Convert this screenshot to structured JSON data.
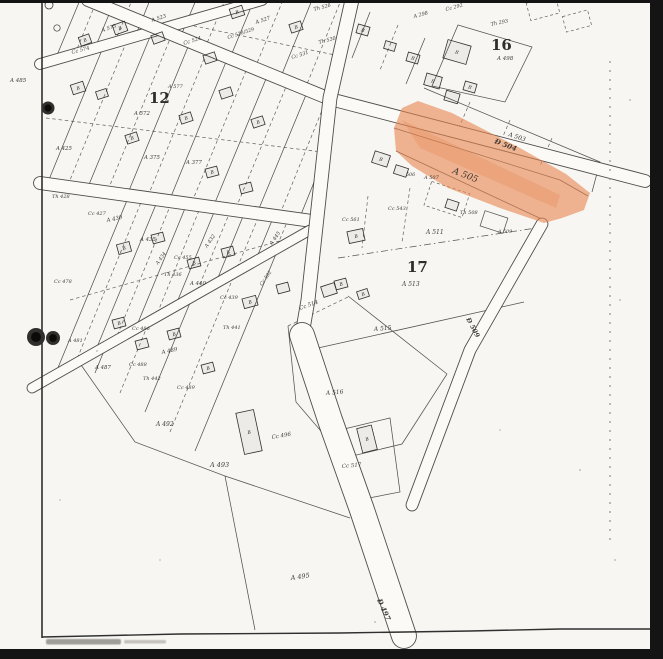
{
  "page": {
    "paper_color": "#f7f6f2",
    "ink_color": "#2e2c28",
    "scan_bar_color": "#141414",
    "highlight_color": "#e8854e"
  },
  "map": {
    "description": "scanned cadastral parcel map sheet with orange-highlighted parcel",
    "highlighted_parcel": "A 505",
    "block_numbers": [
      {
        "text": "12",
        "x": 149,
        "y": 103,
        "size": 15
      },
      {
        "text": "16",
        "x": 491,
        "y": 50,
        "size": 15
      },
      {
        "text": "17",
        "x": 407,
        "y": 272,
        "size": 15
      }
    ],
    "road_labels": [
      {
        "text": "Đ 504",
        "x": 494,
        "y": 143,
        "rot": 21,
        "size": 7
      },
      {
        "text": "Đ 497",
        "x": 377,
        "y": 600,
        "rot": 66,
        "size": 7
      },
      {
        "text": "Đ 509",
        "x": 466,
        "y": 319,
        "rot": 62,
        "size": 6.5
      }
    ],
    "margin_labels": [
      {
        "text": "A 485",
        "x": 10,
        "y": 82,
        "rot": 0,
        "size": 5.5
      }
    ],
    "parcel_labels": [
      {
        "text": "Cc 574",
        "x": 72,
        "y": 54,
        "rot": -15,
        "size": 5.2
      },
      {
        "text": "A 575",
        "x": 102,
        "y": 32,
        "rot": -18,
        "size": 5.2
      },
      {
        "text": "A 523",
        "x": 152,
        "y": 22,
        "rot": -18,
        "size": 5.2
      },
      {
        "text": "Cc 524",
        "x": 184,
        "y": 45,
        "rot": -18,
        "size": 5.2
      },
      {
        "text": "Cc 528/529",
        "x": 228,
        "y": 39,
        "rot": -18,
        "size": 4.8
      },
      {
        "text": "A 527",
        "x": 256,
        "y": 24,
        "rot": -18,
        "size": 5.2
      },
      {
        "text": "Th 526",
        "x": 314,
        "y": 11,
        "rot": -15,
        "size": 5
      },
      {
        "text": "Th 530",
        "x": 319,
        "y": 44,
        "rot": -15,
        "size": 5
      },
      {
        "text": "Cc 531",
        "x": 292,
        "y": 59,
        "rot": -18,
        "size": 5
      },
      {
        "text": "A 298",
        "x": 414,
        "y": 18,
        "rot": -15,
        "size": 5
      },
      {
        "text": "Cc 292",
        "x": 446,
        "y": 11,
        "rot": -15,
        "size": 5
      },
      {
        "text": "Th 293",
        "x": 491,
        "y": 26,
        "rot": -12,
        "size": 5
      },
      {
        "text": "A 572",
        "x": 134,
        "y": 115,
        "rot": 0,
        "size": 5.4
      },
      {
        "text": "A 577",
        "x": 168,
        "y": 88,
        "rot": 0,
        "size": 5
      },
      {
        "text": "A 375",
        "x": 144,
        "y": 159,
        "rot": 0,
        "size": 5.4
      },
      {
        "text": "A 377",
        "x": 186,
        "y": 164,
        "rot": 0,
        "size": 5.4
      },
      {
        "text": "A 425",
        "x": 56,
        "y": 150,
        "rot": 0,
        "size": 5.4
      },
      {
        "text": "Th 428",
        "x": 52,
        "y": 198,
        "rot": 0,
        "size": 5
      },
      {
        "text": "Cc 427",
        "x": 88,
        "y": 215,
        "rot": 0,
        "size": 5
      },
      {
        "text": "A 430",
        "x": 107,
        "y": 222,
        "rot": -12,
        "size": 5.4
      },
      {
        "text": "A 435",
        "x": 140,
        "y": 241,
        "rot": 0,
        "size": 5.4
      },
      {
        "text": "Cc 455",
        "x": 174,
        "y": 259,
        "rot": 0,
        "size": 5
      },
      {
        "text": "A 432",
        "x": 207,
        "y": 248,
        "rot": -55,
        "size": 5
      },
      {
        "text": "A 434",
        "x": 158,
        "y": 265,
        "rot": -55,
        "size": 4.8
      },
      {
        "text": "Th 436",
        "x": 164,
        "y": 276,
        "rot": 0,
        "size": 5
      },
      {
        "text": "A 440",
        "x": 190,
        "y": 285,
        "rot": 0,
        "size": 5.4
      },
      {
        "text": "Cc 439",
        "x": 220,
        "y": 299,
        "rot": 0,
        "size": 5
      },
      {
        "text": "Th 441",
        "x": 223,
        "y": 329,
        "rot": 0,
        "size": 5
      },
      {
        "text": "A 445",
        "x": 272,
        "y": 245,
        "rot": -55,
        "size": 5
      },
      {
        "text": "Cc 502",
        "x": 262,
        "y": 286,
        "rot": -55,
        "size": 4.8
      },
      {
        "text": "Cc 478",
        "x": 54,
        "y": 283,
        "rot": 0,
        "size": 5
      },
      {
        "text": "A 481",
        "x": 68,
        "y": 342,
        "rot": 0,
        "size": 5
      },
      {
        "text": "A 487",
        "x": 95,
        "y": 369,
        "rot": 0,
        "size": 5.4
      },
      {
        "text": "Cc 486",
        "x": 132,
        "y": 330,
        "rot": 0,
        "size": 5
      },
      {
        "text": "A 489",
        "x": 162,
        "y": 354,
        "rot": -12,
        "size": 5.4
      },
      {
        "text": "Cc 488",
        "x": 129,
        "y": 366,
        "rot": 0,
        "size": 5
      },
      {
        "text": "Th 442",
        "x": 143,
        "y": 380,
        "rot": 0,
        "size": 5
      },
      {
        "text": "Cc 489",
        "x": 177,
        "y": 389,
        "rot": 0,
        "size": 5
      },
      {
        "text": "A 492",
        "x": 156,
        "y": 426,
        "rot": 0,
        "size": 6
      },
      {
        "text": "A 493",
        "x": 210,
        "y": 467,
        "rot": 0,
        "size": 6.5
      },
      {
        "text": "Cc 496",
        "x": 272,
        "y": 439,
        "rot": -10,
        "size": 5.5
      },
      {
        "text": "A 495",
        "x": 291,
        "y": 580,
        "rot": -8,
        "size": 6.5
      },
      {
        "text": "A 516",
        "x": 326,
        "y": 395,
        "rot": -5,
        "size": 6
      },
      {
        "text": "Cc 517",
        "x": 342,
        "y": 468,
        "rot": -5,
        "size": 5.5
      },
      {
        "text": "Cc 514",
        "x": 300,
        "y": 310,
        "rot": -20,
        "size": 5.5
      },
      {
        "text": "A 515",
        "x": 374,
        "y": 331,
        "rot": -5,
        "size": 6
      },
      {
        "text": "A 513",
        "x": 402,
        "y": 286,
        "rot": 0,
        "size": 6
      },
      {
        "text": "A 511",
        "x": 426,
        "y": 234,
        "rot": 0,
        "size": 6
      },
      {
        "text": "Cc 561",
        "x": 342,
        "y": 221,
        "rot": 0,
        "size": 5
      },
      {
        "text": "Cc 543",
        "x": 388,
        "y": 210,
        "rot": 0,
        "size": 5
      },
      {
        "text": "Th 508",
        "x": 460,
        "y": 214,
        "rot": 0,
        "size": 5
      },
      {
        "text": "A 509",
        "x": 498,
        "y": 233,
        "rot": 0,
        "size": 4.8
      },
      {
        "text": "A 507",
        "x": 424,
        "y": 179,
        "rot": 0,
        "size": 5
      },
      {
        "text": "506",
        "x": 406,
        "y": 176,
        "rot": 0,
        "size": 4.8
      },
      {
        "text": "A 505",
        "x": 452,
        "y": 173,
        "rot": 21,
        "size": 9
      },
      {
        "text": "A 503",
        "x": 508,
        "y": 136,
        "rot": 18,
        "size": 6
      },
      {
        "text": "A 498",
        "x": 497,
        "y": 60,
        "rot": 0,
        "size": 5.5
      }
    ],
    "buildings": [
      {
        "x": 120,
        "y": 28,
        "w": 13,
        "h": 10,
        "rot": -20,
        "letter": "B"
      },
      {
        "x": 158,
        "y": 38,
        "w": 12,
        "h": 9,
        "rot": -20,
        "letter": ""
      },
      {
        "x": 237,
        "y": 12,
        "w": 13,
        "h": 10,
        "rot": -18,
        "letter": "B"
      },
      {
        "x": 296,
        "y": 27,
        "w": 12,
        "h": 9,
        "rot": -18,
        "letter": "B"
      },
      {
        "x": 210,
        "y": 58,
        "w": 12,
        "h": 9,
        "rot": -18,
        "letter": ""
      },
      {
        "x": 85,
        "y": 40,
        "w": 11,
        "h": 9,
        "rot": -20,
        "letter": "B"
      },
      {
        "x": 78,
        "y": 88,
        "w": 13,
        "h": 10,
        "rot": -18,
        "letter": "B"
      },
      {
        "x": 102,
        "y": 94,
        "w": 11,
        "h": 8,
        "rot": -18,
        "letter": ""
      },
      {
        "x": 132,
        "y": 138,
        "w": 12,
        "h": 9,
        "rot": -18,
        "letter": "B"
      },
      {
        "x": 186,
        "y": 118,
        "w": 12,
        "h": 9,
        "rot": -18,
        "letter": "B"
      },
      {
        "x": 226,
        "y": 93,
        "w": 12,
        "h": 9,
        "rot": -18,
        "letter": ""
      },
      {
        "x": 258,
        "y": 122,
        "w": 12,
        "h": 9,
        "rot": -18,
        "letter": "B"
      },
      {
        "x": 212,
        "y": 172,
        "w": 12,
        "h": 9,
        "rot": -15,
        "letter": "B"
      },
      {
        "x": 246,
        "y": 188,
        "w": 12,
        "h": 9,
        "rot": -15,
        "letter": ""
      },
      {
        "x": 363,
        "y": 30,
        "w": 12,
        "h": 9,
        "rot": 16,
        "letter": "B"
      },
      {
        "x": 390,
        "y": 46,
        "w": 11,
        "h": 8,
        "rot": 16,
        "letter": ""
      },
      {
        "x": 413,
        "y": 58,
        "w": 12,
        "h": 9,
        "rot": 16,
        "letter": "B"
      },
      {
        "x": 457,
        "y": 52,
        "w": 24,
        "h": 19,
        "rot": 16,
        "letter": "B"
      },
      {
        "x": 433,
        "y": 81,
        "w": 16,
        "h": 12,
        "rot": 16,
        "letter": "B"
      },
      {
        "x": 452,
        "y": 97,
        "w": 14,
        "h": 10,
        "rot": 16,
        "letter": ""
      },
      {
        "x": 470,
        "y": 87,
        "w": 12,
        "h": 9,
        "rot": 16,
        "letter": "B"
      },
      {
        "x": 381,
        "y": 159,
        "w": 16,
        "h": 12,
        "rot": 18,
        "letter": "B"
      },
      {
        "x": 401,
        "y": 171,
        "w": 13,
        "h": 9,
        "rot": 18,
        "letter": ""
      },
      {
        "x": 356,
        "y": 236,
        "w": 16,
        "h": 12,
        "rot": -12,
        "letter": "B"
      },
      {
        "x": 341,
        "y": 284,
        "w": 12,
        "h": 9,
        "rot": -15,
        "letter": "B"
      },
      {
        "x": 329,
        "y": 290,
        "w": 14,
        "h": 11,
        "rot": -18,
        "letter": ""
      },
      {
        "x": 363,
        "y": 294,
        "w": 11,
        "h": 8,
        "rot": -18,
        "letter": "B"
      },
      {
        "x": 367,
        "y": 439,
        "w": 15,
        "h": 25,
        "rot": -14,
        "letter": "B"
      },
      {
        "x": 249,
        "y": 432,
        "w": 18,
        "h": 42,
        "rot": -12,
        "letter": "B"
      },
      {
        "x": 124,
        "y": 248,
        "w": 13,
        "h": 10,
        "rot": -15,
        "letter": "B"
      },
      {
        "x": 158,
        "y": 238,
        "w": 12,
        "h": 9,
        "rot": -15,
        "letter": ""
      },
      {
        "x": 194,
        "y": 263,
        "w": 12,
        "h": 9,
        "rot": -15,
        "letter": "B"
      },
      {
        "x": 228,
        "y": 252,
        "w": 12,
        "h": 9,
        "rot": -15,
        "letter": "B"
      },
      {
        "x": 250,
        "y": 302,
        "w": 14,
        "h": 10,
        "rot": -15,
        "letter": "B"
      },
      {
        "x": 283,
        "y": 288,
        "w": 12,
        "h": 9,
        "rot": -15,
        "letter": ""
      },
      {
        "x": 119,
        "y": 323,
        "w": 12,
        "h": 9,
        "rot": -15,
        "letter": "B"
      },
      {
        "x": 142,
        "y": 344,
        "w": 12,
        "h": 9,
        "rot": -15,
        "letter": ""
      },
      {
        "x": 174,
        "y": 334,
        "w": 12,
        "h": 9,
        "rot": -15,
        "letter": "B"
      },
      {
        "x": 208,
        "y": 368,
        "w": 12,
        "h": 9,
        "rot": -15,
        "letter": "B"
      },
      {
        "x": 452,
        "y": 205,
        "w": 12,
        "h": 9,
        "rot": 18,
        "letter": ""
      }
    ],
    "binder_holes": [
      {
        "x": 48,
        "y": 108,
        "r": 6.5
      },
      {
        "x": 36,
        "y": 337,
        "r": 9
      },
      {
        "x": 53,
        "y": 338,
        "r": 7
      }
    ]
  }
}
